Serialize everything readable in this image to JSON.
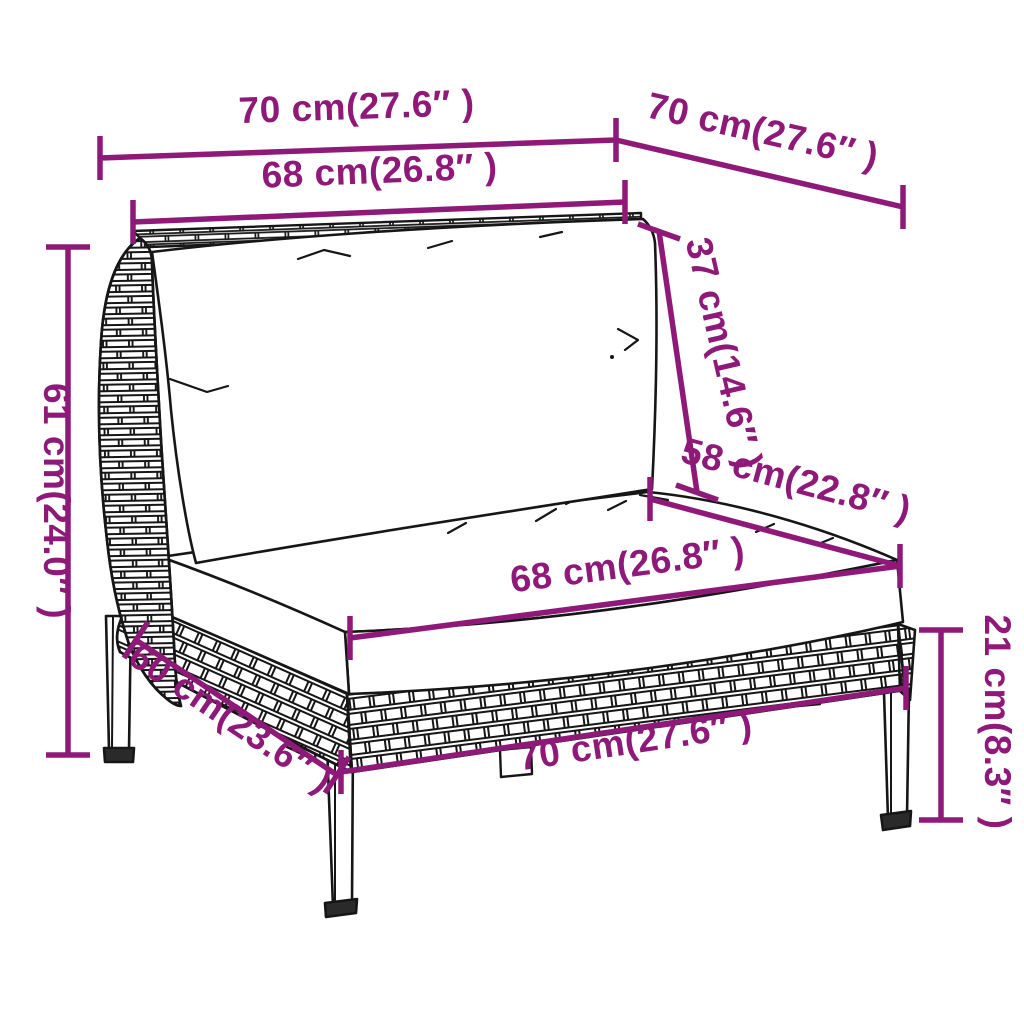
{
  "diagram": {
    "title": "rattan-sofa-section-dimension-diagram",
    "product": "poly rattan garden sofa middle section with back and seat cushions",
    "colors": {
      "dimension_accent": "#8E1979",
      "drawing_line": "#161616",
      "background": "#ffffff"
    },
    "dimensions": [
      {
        "id": "top-width-front",
        "label": "70 cm(27.6″ )"
      },
      {
        "id": "top-depth",
        "label": "70 cm(27.6″ )"
      },
      {
        "id": "back-cushion-width",
        "label": "68 cm(26.8″ )"
      },
      {
        "id": "back-cushion-height",
        "label": "37 cm(14.6″ )"
      },
      {
        "id": "overall-height",
        "label": "61 cm(24.0″ )"
      },
      {
        "id": "seat-depth",
        "label": "58 cm(22.8″ )"
      },
      {
        "id": "seat-cushion-width",
        "label": "68 cm(26.8″ )"
      },
      {
        "id": "base-side-depth",
        "label": "60 cm(23.6″ )"
      },
      {
        "id": "base-front-width",
        "label": "70 cm(27.6″ )"
      },
      {
        "id": "leg-height",
        "label": "21 cm(8.3″ )"
      }
    ]
  }
}
